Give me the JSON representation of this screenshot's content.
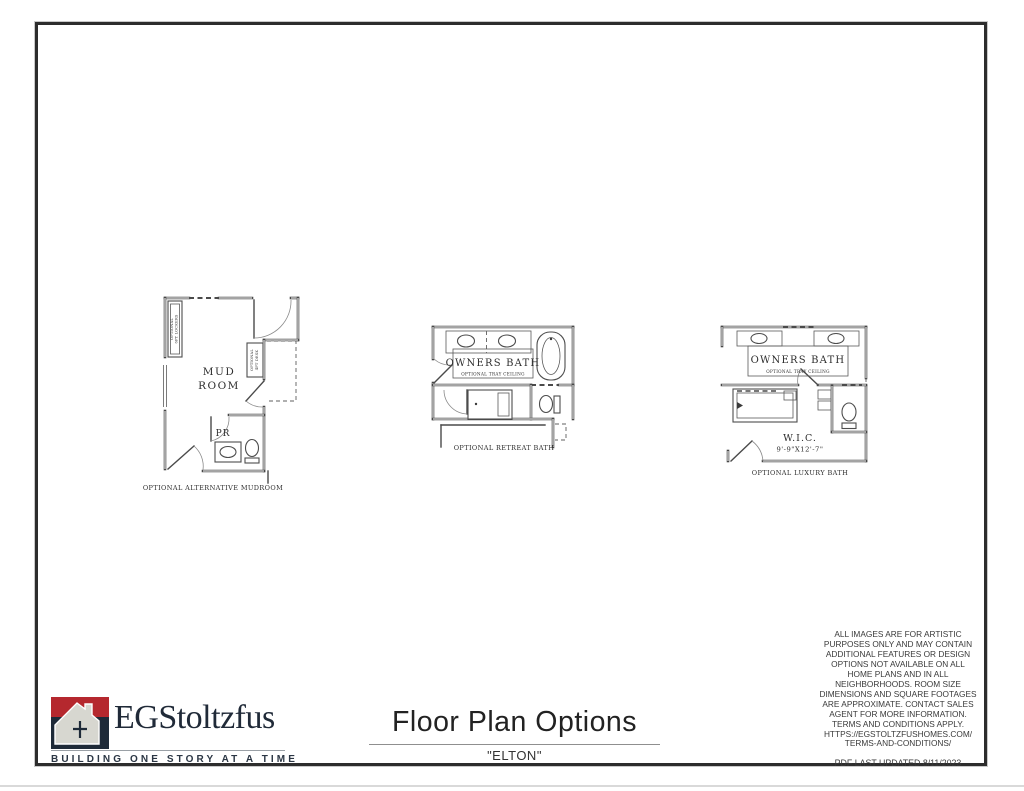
{
  "page": {
    "title": "Floor Plan Options",
    "subtitle": "\"ELTON\""
  },
  "logo": {
    "brand": "EGStoltzfus",
    "tagline": "BUILDING ONE STORY AT A TIME",
    "colors": {
      "red": "#b5282e",
      "navy": "#1e2a38",
      "house": "#d7d7d0"
    }
  },
  "plans": {
    "mudroom": {
      "room_line1": "MUD",
      "room_line2": "ROOM",
      "pr": "PR",
      "lockers_line1": "OPTIONAL",
      "lockers_line2": "6FT LOCKERS",
      "desk_line1": "OPTIONAL",
      "desk_line2": "4FT DESK",
      "caption": "OPTIONAL ALTERNATIVE MUDROOM"
    },
    "retreat": {
      "room": "OWNERS BATH",
      "tray": "OPTIONAL TRAY CEILING",
      "caption": "OPTIONAL RETREAT BATH"
    },
    "luxury": {
      "room": "OWNERS BATH",
      "tray": "OPTIONAL TRAY CEILING",
      "wic": "W.I.C.",
      "wic_dims": "9'-9\"X12'-7\"",
      "caption": "OPTIONAL LUXURY BATH"
    }
  },
  "disclaimer": {
    "text": "ALL IMAGES ARE FOR ARTISTIC\nPURPOSES ONLY AND MAY CONTAIN\nADDITIONAL FEATURES OR DESIGN\nOPTIONS NOT AVAILABLE ON ALL\nHOME PLANS AND IN ALL\nNEIGHBORHOODS.  ROOM SIZE\nDIMENSIONS AND SQUARE FOOTAGES\nARE APPROXIMATE.  CONTACT SALES\nAGENT FOR MORE INFORMATION.\nTERMS AND CONDITIONS APPLY.\nHTTPS://EGSTOLTZFUSHOMES.COM/\nTERMS-AND-CONDITIONS/",
    "pdf_updated": "PDF LAST UPDATED 8/11/2023"
  }
}
